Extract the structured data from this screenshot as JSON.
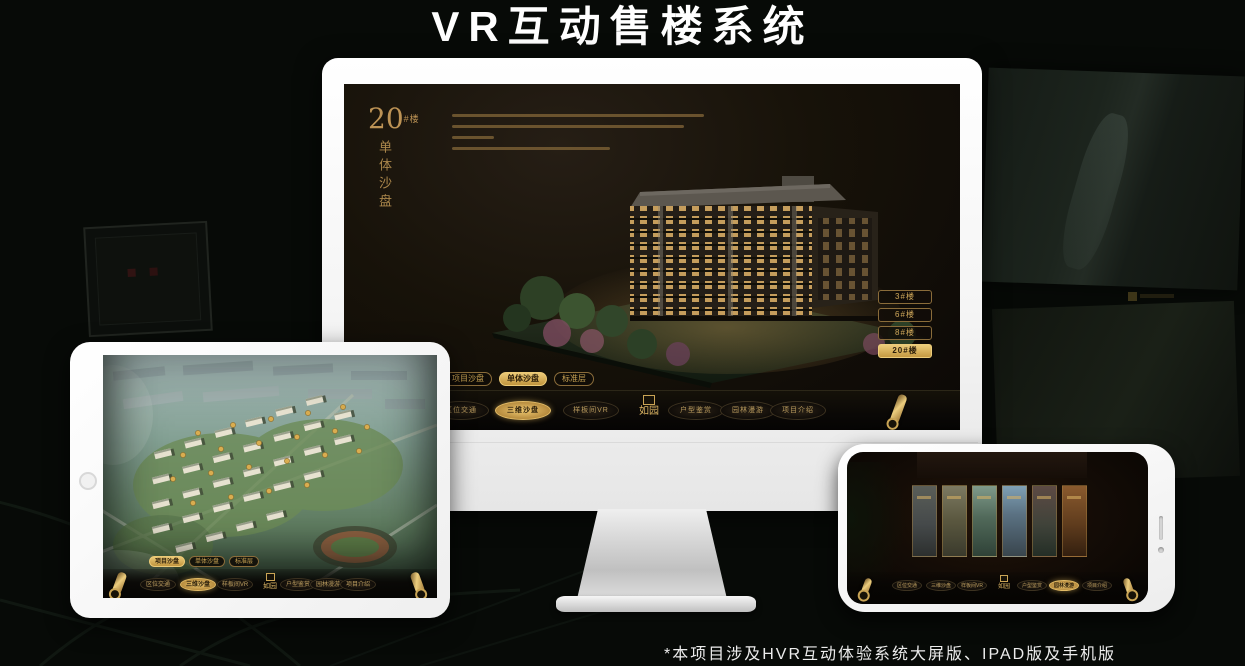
{
  "banner": {
    "title": "VR互动售楼系统"
  },
  "footnote": {
    "text": "*本项目涉及HVR互动体验系统大屏版、IPAD版及手机版"
  },
  "nav": {
    "logo": "如园",
    "items": [
      {
        "label": "区位交通"
      },
      {
        "label": "三维沙盘"
      },
      {
        "label": "样板间VR"
      },
      {
        "label": "户型鉴赏"
      },
      {
        "label": "园林漫游"
      },
      {
        "label": "项目介绍"
      }
    ],
    "sub_tabs": [
      {
        "label": "项目沙盘"
      },
      {
        "label": "单体沙盘"
      },
      {
        "label": "标准层"
      }
    ]
  },
  "monitor_ui": {
    "hero_number": "20",
    "hero_suffix": "#楼",
    "hero_title": "单体沙盘",
    "floor_buttons": [
      {
        "label": "3#楼",
        "active": false
      },
      {
        "label": "6#楼",
        "active": false
      },
      {
        "label": "8#楼",
        "active": false
      },
      {
        "label": "20#楼",
        "active": true
      }
    ],
    "active_nav": "三维沙盘",
    "active_sub_tab": "单体沙盘"
  },
  "tablet_ui": {
    "active_nav": "三维沙盘",
    "active_sub_tab": "项目沙盘"
  },
  "phone_ui": {
    "active_nav": "园林漫游"
  },
  "colors": {
    "gold": "#c9a050",
    "gold_bright": "#e8c470",
    "screen_bg": "#14100b"
  }
}
